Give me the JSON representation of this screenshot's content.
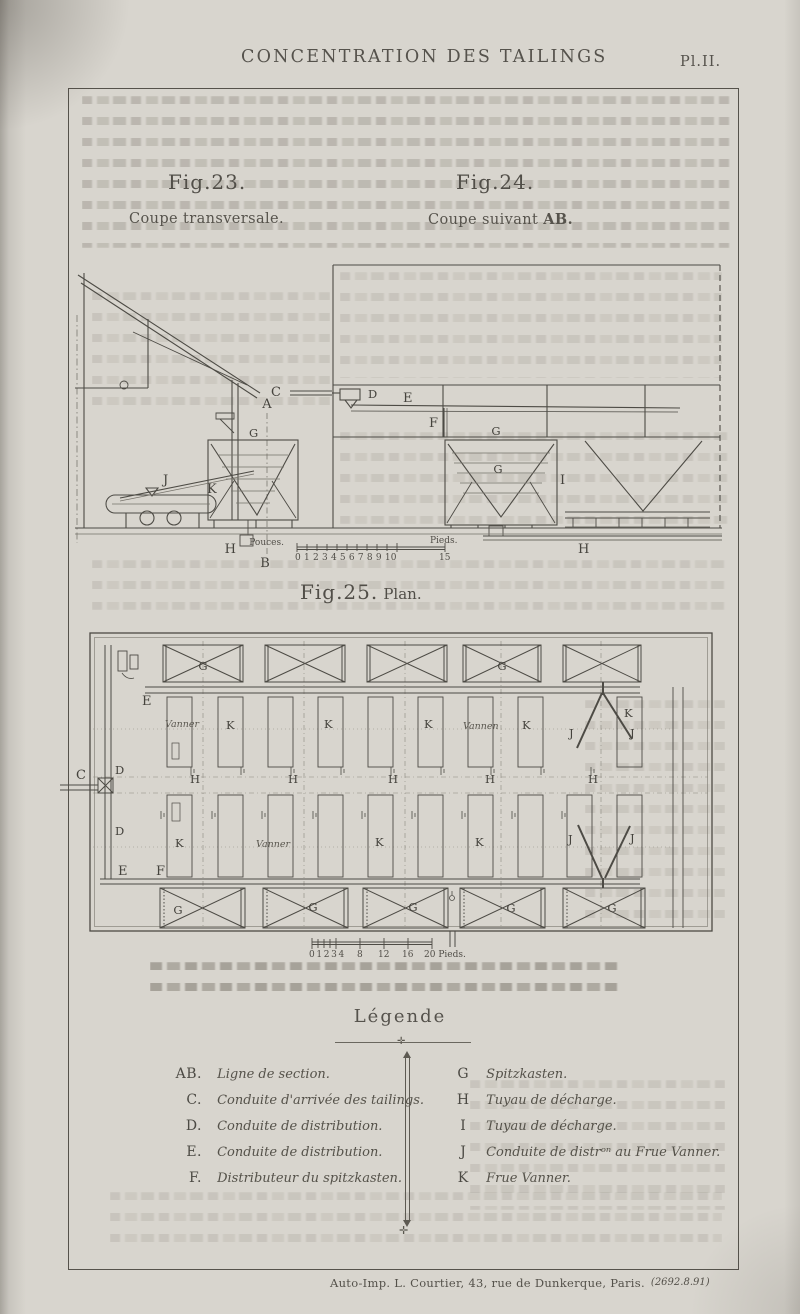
{
  "page": {
    "title": "CONCENTRATION DES TAILINGS",
    "plate": "Pl.II.",
    "imprint": "Auto-Imp. L. Courtier, 43, rue de Dunkerque, Paris.",
    "imprint_ref": "(2692.8.91)"
  },
  "figures": {
    "fig23": {
      "number": "Fig.23.",
      "caption": "Coupe transversale."
    },
    "fig24": {
      "number": "Fig.24.",
      "caption_prefix": "Coupe suivant ",
      "caption_ab": "AB."
    },
    "fig25": {
      "number": "Fig.25.",
      "caption": "Plan."
    }
  },
  "scales": {
    "pouces_bar": {
      "left_unit": "Pouces.",
      "numbers": "0 1 2 3 4 5 6 7 8 9 10",
      "right_unit": "Pieds.",
      "right_number": "15"
    },
    "pieds_bar": {
      "n0": "0 1 2 3 4",
      "n8": "8",
      "n12": "12",
      "n16": "16",
      "n20": "20 Pieds."
    }
  },
  "letters": {
    "A": "A",
    "B": "B",
    "C": "C",
    "D": "D",
    "E": "E",
    "F": "F",
    "G": "G",
    "H": "H",
    "I": "I",
    "J": "J",
    "K": "K",
    "vanner": "Vanner",
    "vannen": "Vannen"
  },
  "legend": {
    "title": "Légende",
    "left": [
      {
        "key": "AB.",
        "desc": "Ligne de section."
      },
      {
        "key": "C.",
        "desc": "Conduite d'arrivée des tailings."
      },
      {
        "key": "D.",
        "desc": "Conduite de distribution."
      },
      {
        "key": "E.",
        "desc": "Conduite de distribution."
      },
      {
        "key": "F.",
        "desc": "Distributeur du spitzkasten."
      }
    ],
    "right": [
      {
        "key": "G",
        "desc": "Spitzkasten."
      },
      {
        "key": "H",
        "desc": "Tuyau de décharge."
      },
      {
        "key": "I",
        "desc": "Tuyau de décharge."
      },
      {
        "key": "J",
        "desc": "Conduite de distrᵒⁿ au Frue Vanner."
      },
      {
        "key": "K",
        "desc": "Frue Vanner."
      }
    ]
  },
  "colors": {
    "paper": "#d8d5ce",
    "ink": "#4a4843",
    "faint": "#7b786f"
  }
}
